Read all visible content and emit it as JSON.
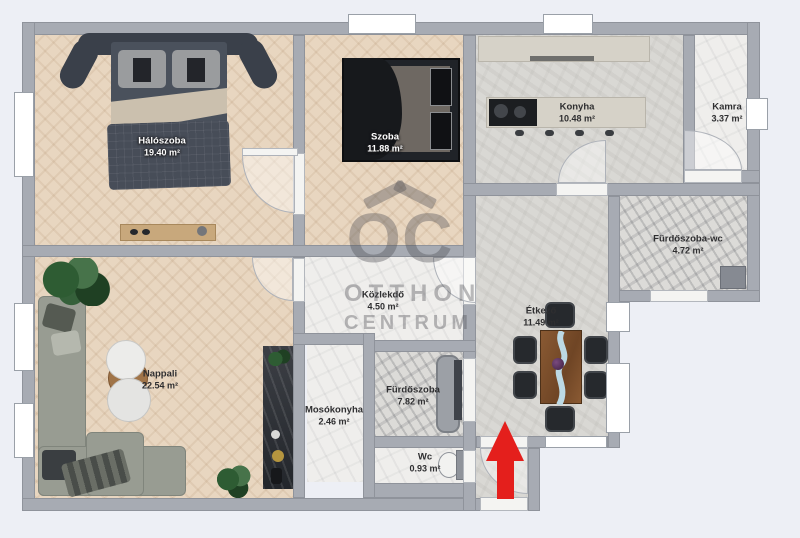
{
  "watermark": {
    "logo": "OC",
    "line1": "OTTHON",
    "line2": "CENTRUM"
  },
  "rooms": [
    {
      "id": "haloszoba",
      "name": "Hálószoba",
      "area": "19.40 m²"
    },
    {
      "id": "szoba",
      "name": "Szoba",
      "area": "11.88 m²"
    },
    {
      "id": "konyha",
      "name": "Konyha",
      "area": "10.48 m²"
    },
    {
      "id": "kamra",
      "name": "Kamra",
      "area": "3.37 m²"
    },
    {
      "id": "furdoszoba-wc",
      "name": "Fürdőszoba-wc",
      "area": "4.72 m²"
    },
    {
      "id": "kozlekdo",
      "name": "Közlekdő",
      "area": "4.50 m²"
    },
    {
      "id": "etkezo",
      "name": "Étkező",
      "area": "11.49 m²"
    },
    {
      "id": "nappali",
      "name": "Nappali",
      "area": "22.54 m²"
    },
    {
      "id": "mosokonyha",
      "name": "Mosókonyha",
      "area": "2.46 m²"
    },
    {
      "id": "furdoszoba",
      "name": "Fürdőszoba",
      "area": "7.82 m²"
    },
    {
      "id": "wc",
      "name": "Wc",
      "area": "0.93 m²"
    }
  ],
  "colors": {
    "background": "#edeff5",
    "wall": "#a7abb3",
    "wood_floor": "#e8d6c0",
    "entrance_arrow": "#e41f1c",
    "watermark": "rgba(78,78,84,0.38)"
  }
}
